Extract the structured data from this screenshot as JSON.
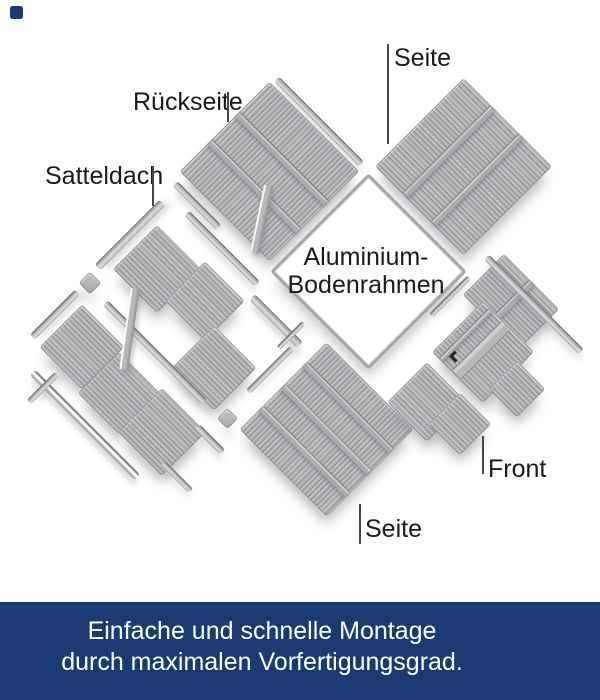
{
  "diagram": {
    "labels": {
      "satteldach": "Satteldach",
      "rueckseite": "Rückseite",
      "seite_top": "Seite",
      "seite_bottom": "Seite",
      "front": "Front",
      "floor_frame_line1": "Aluminium-",
      "floor_frame_line2": "Bodenrahmen"
    }
  },
  "banner": {
    "line1": "Einfache und schnelle Montage",
    "line2": "durch maximalen Vorfertigungsgrad.",
    "background": "#1a3b72",
    "text_color": "#ffffff"
  },
  "colors": {
    "page_background": "#ffffff",
    "panel_gray": "#b0b2b4",
    "stripe_dark": "#8e9094",
    "stripe_light": "#c6c8ca",
    "label_text": "#1a1a1a",
    "connector_line": "#454545",
    "brand_navy": "#1a3b72"
  }
}
